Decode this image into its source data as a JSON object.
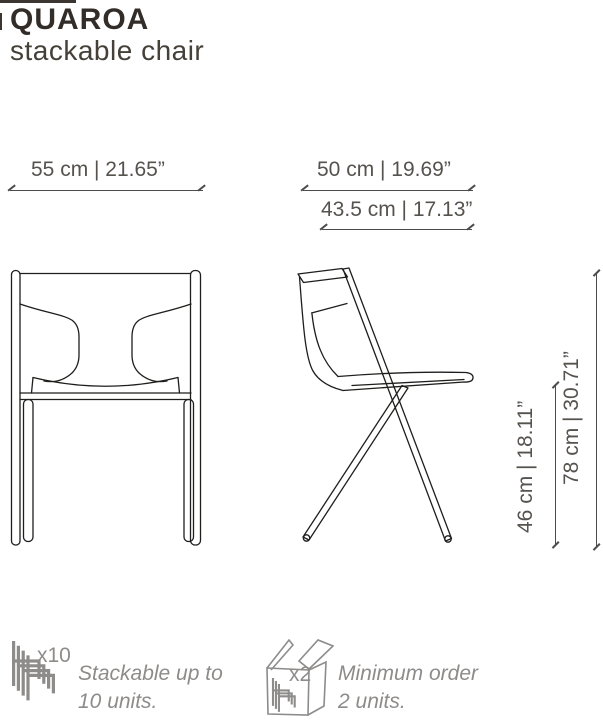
{
  "header": {
    "title": "QUAROA",
    "subtitle": "stackable chair"
  },
  "dimensions": {
    "width": "55 cm | 21.65”",
    "depth": "50 cm | 19.69”",
    "seat_depth": "43.5 cm | 17.13”",
    "seat_height": "46 cm | 18.11”",
    "height": "78 cm | 30.71”"
  },
  "features": [
    {
      "icon": "stacked-chairs-icon",
      "badge": "x10",
      "line1": "Stackable up to",
      "line2": "10 units."
    },
    {
      "icon": "boxed-chairs-icon",
      "badge": "x2",
      "line1": "Minimum order",
      "line2": "2 units."
    }
  ],
  "colors": {
    "title": "#322d29",
    "subtitle": "#454139",
    "dimension_text": "#56524e",
    "dimension_line": "#4c4c4c",
    "drawing_line": "#1e1e1c",
    "feature_gray": "#8e8c8a",
    "background": "#ffffff"
  }
}
